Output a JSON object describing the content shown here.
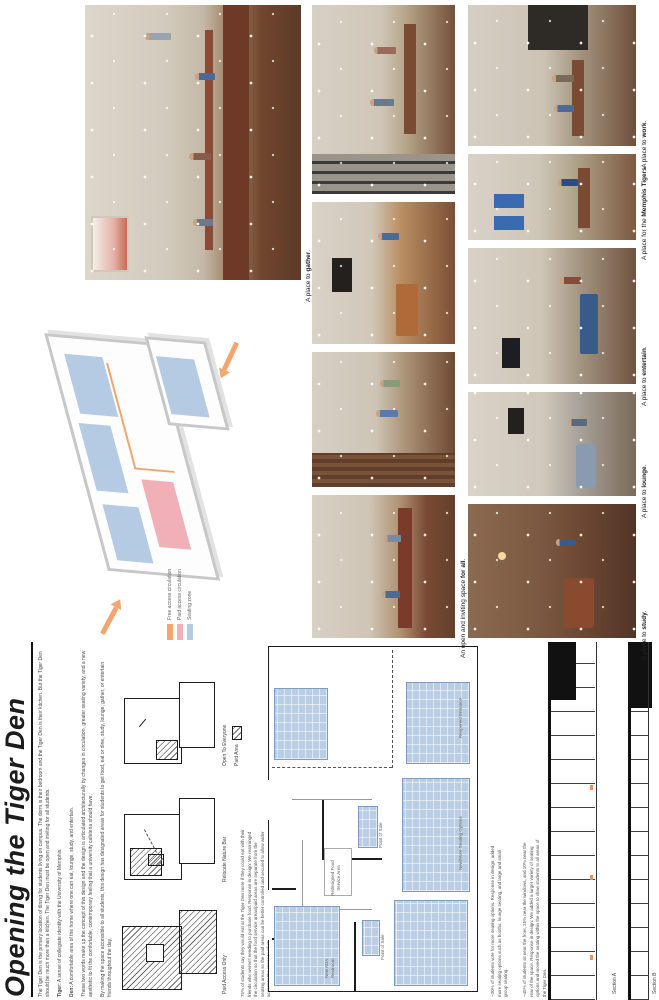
{
  "poster": {
    "title": "Opening the Tiger Den"
  },
  "intro": {
    "p1": "The Tiger Den is the primary location of dining for students living on campus. The dorm is their bedroom and the Tiger Den is their kitchen. But the Tiger Den should be much more than a kitchen. The Tiger Den must be open and inviting for all students.",
    "tiger_label": "Tiger:",
    "tiger_text": "A sense of collegiate identity with the University of Memphis.",
    "den_label": "Den:",
    "den_text": "A comfortable area of the home where one can eat, lounge, study, and entertain.",
    "p4": "These two words make up the concept of this design and the design is articulated architecturally by changes in circulation, greater seating variety, and a new aesthetic to fit the comfortable, contemporary feeling that a university cafeteria should have.",
    "p5": "By making the space accessible to all students, this design has designated areas for students to get food, eat or dine, study, lounge, gather, or entertain friends throughout the day."
  },
  "concept_diagrams": {
    "items": [
      {
        "caption": "Paid Access Only"
      },
      {
        "caption": "Relocate Nature Bar"
      },
      {
        "caption": "Open To Everyone"
      }
    ],
    "paid_area_label": "Paid Area",
    "note": "75% of students say they would eat at the Tiger Den more if they could eat with their friends who weren't needing to purchase food. Response in design: We rearranged the circulation so that the food service areas/paid areas are separate from the seating areas so the paid areas can be better controlled and secured to allow wider access to the space to all students."
  },
  "floor_plan": {
    "labels": {
      "food_service": "Redesigned Food Service Area",
      "point_of_sale_1": "Point of Sale",
      "point_of_sale_2": "Point of Sale",
      "ada_restroom": "New ADA Restroom",
      "seating_options": "New/More Seating Options",
      "entrance": "Reopened Entrance"
    },
    "stats": {
      "seating": "~30% of students vote for more seating options. Response in design: added more seating options such as booths, lounge seating, and large and small group seating.",
      "location": "~45% of students sit near the front, 25% near the windows, and 10% near the rear of the space. Response in design: We added a larger variety of seating options and moved the seating within the space to draw students to all areas of the Tiger Den."
    }
  },
  "axon": {
    "legend": [
      {
        "label": "Free access circulation",
        "color": "#f2a56e"
      },
      {
        "label": "Paid access circulation",
        "color": "#f1b0b8"
      },
      {
        "label": "Seating zone",
        "color": "#b5cae3"
      }
    ]
  },
  "sections": {
    "a_label": "Section A",
    "b_label": "Section B"
  },
  "render_captions": {
    "gather": {
      "pre": "A place to ",
      "bold": "gather",
      "post": "."
    },
    "for_all": {
      "pre": "An open and inviting space ",
      "bold": "for all",
      "post": "."
    },
    "study": {
      "pre": "A place to ",
      "bold": "study",
      "post": "."
    },
    "lounge": {
      "pre": "A place to ",
      "bold": "lounge",
      "post": "."
    },
    "entertain": {
      "pre": "A place to ",
      "bold": "entertain",
      "post": "."
    },
    "memphis": {
      "pre": "A place for the ",
      "bold": "Memphis Tigers",
      "post": "."
    },
    "work": {
      "pre": "A place to ",
      "bold": "work",
      "post": "."
    }
  },
  "colors": {
    "title_ink": "#1c1c1c",
    "plan_seating_blue": "#b9cde5",
    "free_circulation_orange": "#f2a56e",
    "paid_circulation_pink": "#f1b0b8",
    "seating_zone_blue": "#b5cae3",
    "hatch_grey": "#6b6b6b"
  }
}
